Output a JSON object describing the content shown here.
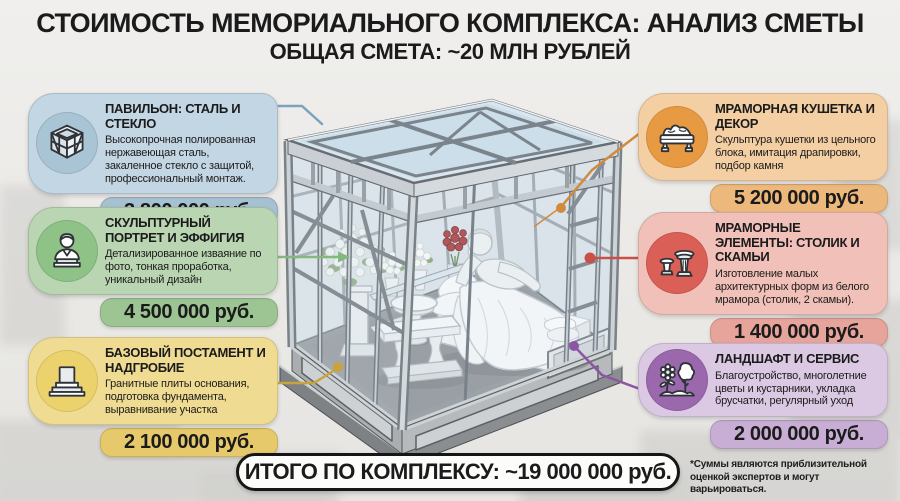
{
  "header": {
    "title": "СТОИМОСТЬ МЕМОРИАЛЬНОГО КОМПЛЕКСА: АНАЛИЗ СМЕТЫ",
    "subtitle": "ОБЩАЯ СМЕТА: ~20 МЛН РУБЛЕЙ"
  },
  "cards": [
    {
      "title": "ПАВИЛЬОН: СТАЛЬ И СТЕКЛО",
      "description": "Высокопрочная полированная нержавеющая сталь, закаленное стекло с защитой, профессиональный монтаж.",
      "price": "3 800 000 руб.",
      "icon": "pavilion-icon",
      "colors": {
        "body": "#c3d6e3",
        "bar": "#a6c1d2",
        "circle": "#a9c4d4"
      }
    },
    {
      "title": "СКУЛЬПТУРНЫЙ ПОРТРЕТ И ЭФФИГИЯ",
      "description": "Детализированное изваяние по фото, тонкая проработка, уникальный дизайн",
      "price": "4 500 000 руб.",
      "icon": "bust-icon",
      "colors": {
        "body": "#b9d5b1",
        "bar": "#9cc593",
        "circle": "#8ec287"
      }
    },
    {
      "title": "БАЗОВЫЙ ПОСТАМЕНТ И НАДГРОБИЕ",
      "description": "Гранитные плиты основания, подготовка фундамента, выравнивание участка",
      "price": "2 100 000 руб.",
      "icon": "pedestal-icon",
      "colors": {
        "body": "#efdc92",
        "bar": "#e6c96a",
        "circle": "#ecd26d"
      }
    },
    {
      "title": "МРАМОРНАЯ КУШЕТКА И ДЕКОР",
      "description": "Скульптура кушетки из цельного блока, имитация драпировки, подбор камня",
      "price": "5 200 000 руб.",
      "icon": "couch-icon",
      "colors": {
        "body": "#f3cfa3",
        "bar": "#ecb87c",
        "circle": "#e89a43"
      }
    },
    {
      "title": "МРАМОРНЫЕ ЭЛЕМЕНТЫ: СТОЛИК И СКАМЬИ",
      "description": "Изготовление малых архитектурных форм из белого мрамора (столик, 2 скамьи).",
      "price": "1 400 000 руб.",
      "icon": "table-bench-icon",
      "colors": {
        "body": "#f1c0b9",
        "bar": "#e7a49b",
        "circle": "#d95f57"
      }
    },
    {
      "title": "ЛАНДШАФТ И СЕРВИС",
      "description": "Благоустройство, многолетние цветы и кустарники, укладка брусчатки, регулярный уход",
      "price": "2 000 000 руб.",
      "icon": "landscape-icon",
      "colors": {
        "body": "#dbc9e4",
        "bar": "#c8add5",
        "circle": "#9b68ae"
      }
    }
  ],
  "connectors": [
    {
      "card": "pavilion",
      "color": "#7ba3bd"
    },
    {
      "card": "sculpture",
      "color": "#85b87f"
    },
    {
      "card": "pedestal",
      "color": "#c9a33d"
    },
    {
      "card": "couch",
      "color": "#d28a3d"
    },
    {
      "card": "marble-elements",
      "color": "#c94f48"
    },
    {
      "card": "landscape",
      "color": "#8d55a4"
    }
  ],
  "total": {
    "label": "ИТОГО ПО КОМПЛЕКСУ: ~19 000 000 руб."
  },
  "footnote": "*Суммы являются приблизительной оценкой экспертов и могут варьироваться."
}
